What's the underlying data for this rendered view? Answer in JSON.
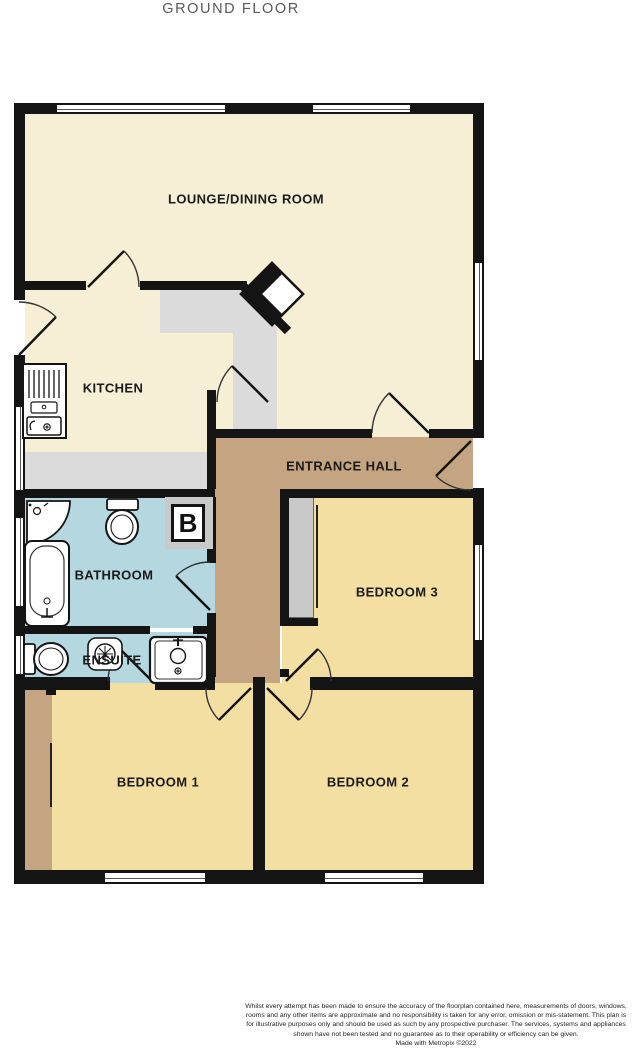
{
  "title": "GROUND FLOOR",
  "plan": {
    "rooms": {
      "lounge": {
        "label": "LOUNGE/DINING ROOM"
      },
      "kitchen": {
        "label": "KITCHEN"
      },
      "entrance_hall": {
        "label": "ENTRANCE HALL"
      },
      "bathroom": {
        "label": "BATHROOM"
      },
      "ensuite": {
        "label": "ENSUITE"
      },
      "bedroom1": {
        "label": "BEDROOM 1"
      },
      "bedroom2": {
        "label": "BEDROOM 2"
      },
      "bedroom3": {
        "label": "BEDROOM 3"
      }
    },
    "boiler_label": "B"
  },
  "colors": {
    "wall": "#141414",
    "cream": "#F6EFD5",
    "yellow": "#F4DFA2",
    "tan": "#C5A482",
    "blue": "#B5D8E0",
    "counter_gray": "#DBDBDB",
    "wardrobe_gray": "#C9C9C9",
    "title_gray": "#58585A"
  },
  "footer": {
    "disclaimer": "Whilst every attempt has been made to ensure the accuracy of the floorplan contained here, measurements of doors, windows, rooms and any other items are approximate and no responsibility is taken for any error, omission or mis-statement. This plan is for illustrative purposes only and should be used as such by any prospective purchaser. The services, systems and appliances shown have not been tested and no guarantee as to their operability or efficiency can be given.",
    "credit": "Made with Metropix ©2022"
  }
}
